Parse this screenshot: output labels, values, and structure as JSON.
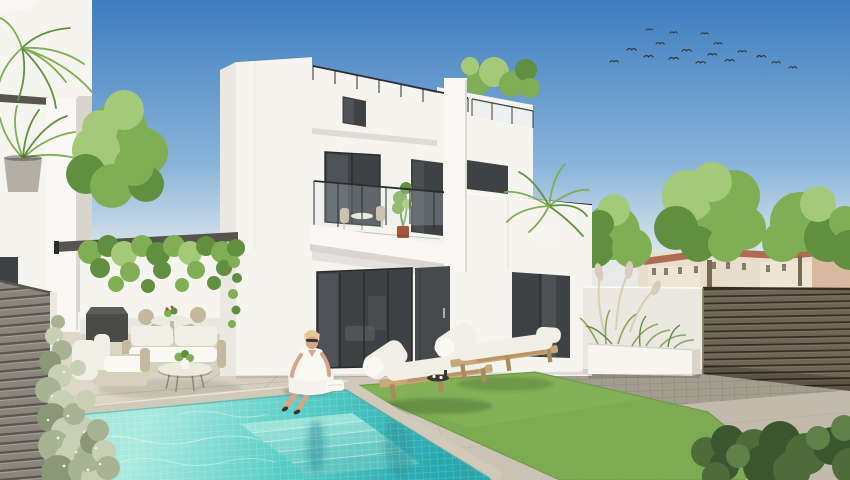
{
  "scene": {
    "caption": "Bright daytime 3D architectural render of a modern two-storey white villa with roof terraces and glass balustrades, a turquoise mosaic swimming pool with underwater steps, two wooden sun loungers with white cushions on an artificial lawn, an outdoor lounge set under a dark pergola, slatted privacy fences, a planter with ornamental grasses, distant Mediterranean apartment buildings, a flock of birds in a blue sky and a woman in white sitting on the pool edge",
    "people_count": 1,
    "sun_lounger_count": 2,
    "bird_count": 17,
    "balcony_count": 2,
    "storeys": 2
  },
  "colors": {
    "sky_top": "#3e7cbe",
    "sky_mid": "#8ab5da",
    "sky_horizon": "#dfe8ec",
    "haze": "#ecebe5",
    "bird": "#35342f",
    "bldg_cream": "#e8decc",
    "bldg_light": "#efe6d6",
    "roof_terracotta": "#b06b55",
    "bldg_window": "#6f6253",
    "bldg_red": "#d9b9a2",
    "roof_red": "#a5604c",
    "tree_light": "#a3c979",
    "tree_mid": "#7fae54",
    "tree_dark": "#60903f",
    "trunk": "#7a6a50",
    "wall_white": "#f6f4ef",
    "wall_bright": "#faf8f4",
    "wall_side": "#ebe8e1",
    "wall_recess": "#d9d5cc",
    "slab_dark": "#56544c",
    "glass": "#3f4245",
    "glass_light": "#5d6164",
    "frame": "#2a2c2e",
    "rail": "#2b2d2e",
    "glass_tint": "#d7e7ec",
    "door": "#474a4d",
    "pot_gray": "#b3afa6",
    "terracotta_pot": "#a8563f",
    "pot_white": "#f7f5f0",
    "fence_left_slat": "#8a867c",
    "fence_left_gap": "#5a564e",
    "fence_right_slat": "#6f6756",
    "fence_right_gap": "#352e23",
    "fence_right_hi": "#857b66",
    "patio_light": "#e0d9ca",
    "patio_dark": "#c2bbad",
    "joint": "#b4ad9e",
    "band_tile": "#a39d90",
    "lawn_light": "#8cba5e",
    "lawn": "#7fae54",
    "lawn_dark": "#6f9c47",
    "pool_light": "#a8e9de",
    "pool_mid": "#57cdc6",
    "pool_deep": "#28a9b0",
    "coping": "#d2cab9",
    "step1": "#a5e6dc",
    "step2": "#99e0d6",
    "step3": "#8bd8cf",
    "step4": "#7bd0c8",
    "step5": "#6cc8c0",
    "cushion": "#f2efe7",
    "cushion_hi": "#faf8f2",
    "wood": "#c9a878",
    "wood_dark": "#ac8a5c",
    "wicker": "#d8d0bc",
    "wicker_dark": "#c4b89e",
    "table_white": "#ecebe0",
    "skin": "#d7a488",
    "hair": "#e3c795",
    "outfit": "#f5f3ed",
    "dark_item": "#3a3633",
    "hedge_light": "#c8cfb4",
    "hedge_mid": "#a8b394",
    "hedge_dark": "#8a9878",
    "hedge_speck": "#eff3e2",
    "bush_dark": "#3c5630",
    "bush_mid": "#4e6b3a",
    "bush_light": "#61814a",
    "plume": "#d9cdb9",
    "grass_green": "#8aa55e"
  }
}
